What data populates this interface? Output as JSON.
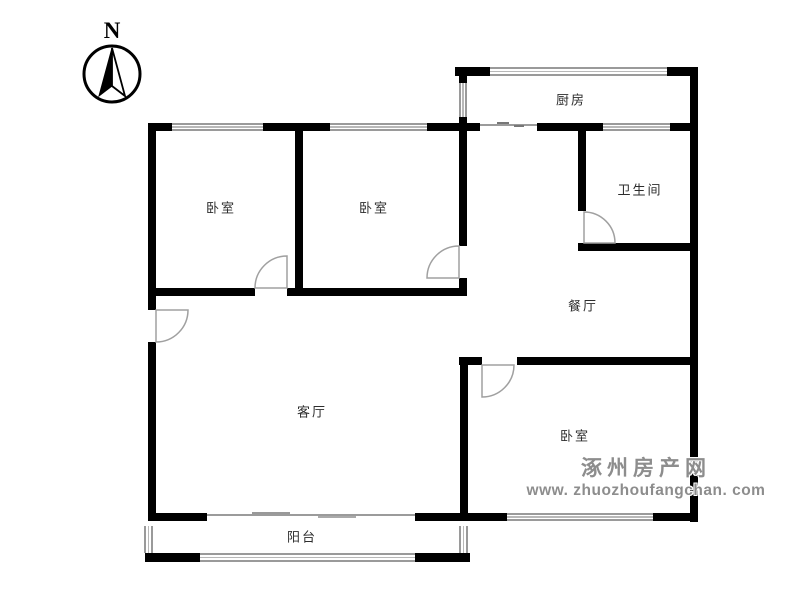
{
  "compass": {
    "label": "N"
  },
  "rooms": [
    {
      "id": "kitchen",
      "label": "厨房"
    },
    {
      "id": "bathroom",
      "label": "卫生间"
    },
    {
      "id": "bedroom-1",
      "label": "卧室"
    },
    {
      "id": "bedroom-2",
      "label": "卧室"
    },
    {
      "id": "dining",
      "label": "餐厅"
    },
    {
      "id": "living",
      "label": "客厅"
    },
    {
      "id": "bedroom-3",
      "label": "卧室"
    },
    {
      "id": "balcony",
      "label": "阳台"
    }
  ],
  "watermark": {
    "line1": "涿州房产网",
    "line2": "www. zhuozhoufangchan. com",
    "color": "#8d8d8d"
  },
  "colors": {
    "wall": "#000000",
    "window_line": "#9a9a9a",
    "door_arc": "#a0a0a0",
    "label_text": "#2d2d2d"
  }
}
